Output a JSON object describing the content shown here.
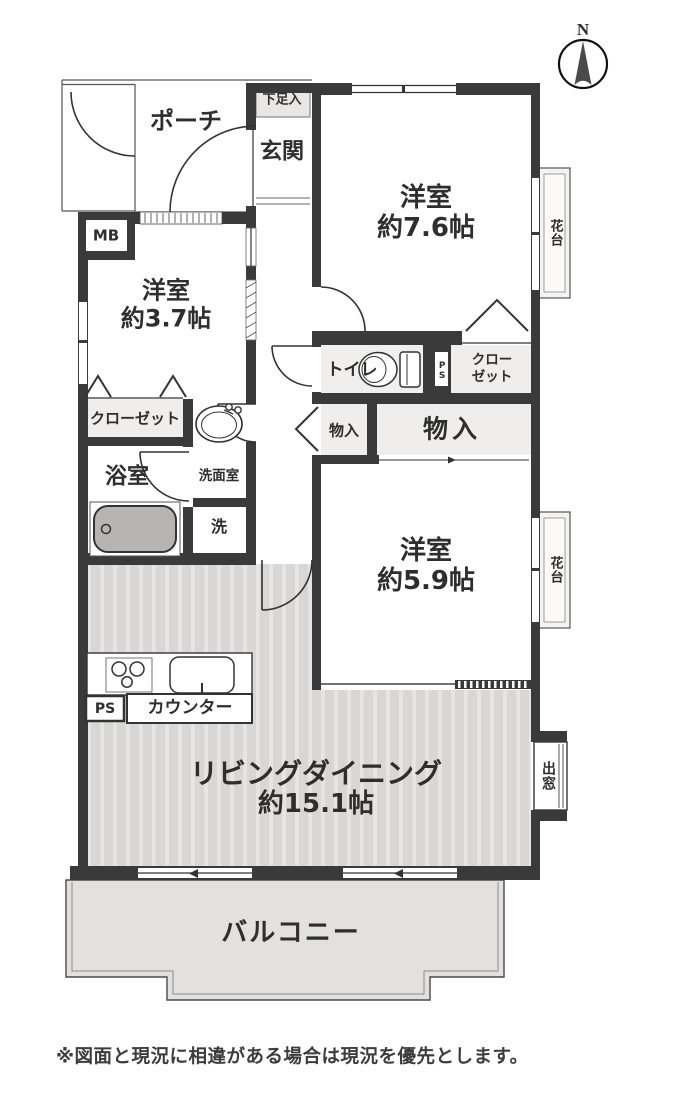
{
  "page": {
    "disclaimer": "※図面と現況に相違がある場合は現況を優先とします。"
  },
  "compass": {
    "label": "N"
  },
  "rooms": {
    "porch": {
      "label": "ポーチ"
    },
    "shoe_cabinet": {
      "label": "下足入"
    },
    "entrance": {
      "label": "玄関"
    },
    "meter_box": {
      "label": "MB"
    },
    "western_room_7_6": {
      "name": "洋室",
      "size": "約7.6帖"
    },
    "western_room_3_7": {
      "name": "洋室",
      "size": "約3.7帖"
    },
    "western_room_5_9": {
      "name": "洋室",
      "size": "約5.9帖"
    },
    "living_dining": {
      "name": "リビングダイニング",
      "size": "約15.1帖"
    },
    "balcony": {
      "label": "バルコニー"
    },
    "bathroom": {
      "label": "浴室"
    },
    "washroom": {
      "label": "洗面室"
    },
    "laundry": {
      "label": "洗"
    },
    "toilet": {
      "label": "トイレ"
    },
    "closet_west": {
      "label": "クローゼット"
    },
    "closet_east": {
      "line1": "クロー",
      "line2": "ゼット"
    },
    "storage_small": {
      "label": "物入"
    },
    "storage_large": {
      "label": "物入"
    },
    "counter": {
      "label": "カウンター"
    },
    "pipe_space_kitchen": {
      "label": "PS"
    },
    "pipe_space_toilet": {
      "label": "PS"
    },
    "flower_stand_north": {
      "label": "花台"
    },
    "flower_stand_south": {
      "label": "花台"
    },
    "bay_window": {
      "label": "出窓"
    }
  },
  "colors": {
    "wall": "#3a3a3a",
    "living_floor": "#d8d7d5",
    "balcony_floor": "#e2e1df",
    "storage_tint": "#efeeec",
    "bathtub": "#b6b5b3"
  }
}
